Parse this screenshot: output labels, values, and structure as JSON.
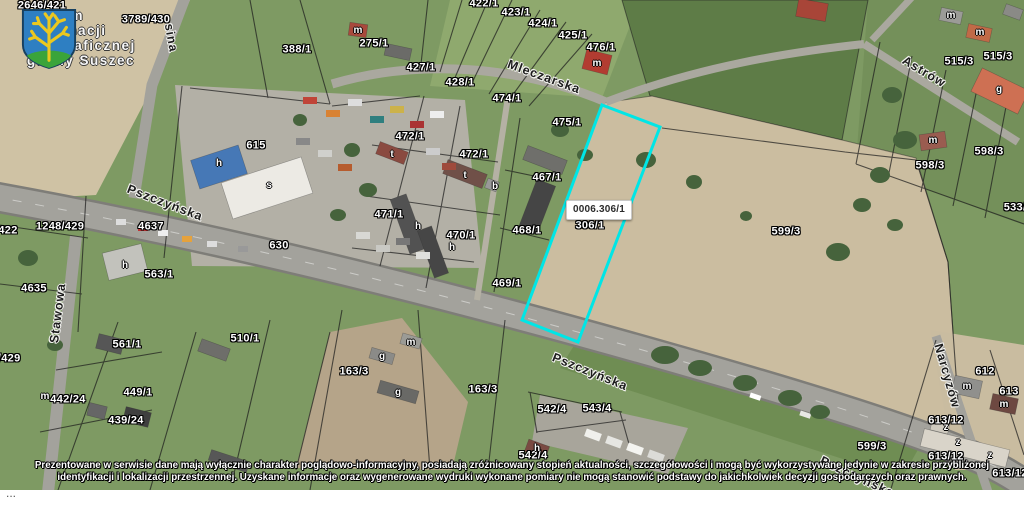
{
  "logo": {
    "lines": [
      "System",
      "Informacji",
      "Geograficznej",
      "gminy Suszec"
    ],
    "shield_colors": {
      "field": "#2e7fc2",
      "tree": "#ecc81f",
      "mound": "#3aa43a"
    }
  },
  "highlight": {
    "label": "0006.306/1",
    "points": "602,105 660,127 578,342 522,320",
    "color": "#00e6e6"
  },
  "map": {
    "parcels": [
      {
        "t": "2646/421",
        "x": 42,
        "y": 6
      },
      {
        "t": "3789/430",
        "x": 146,
        "y": 20
      },
      {
        "t": "388/1",
        "x": 297,
        "y": 50
      },
      {
        "t": "275/1",
        "x": 374,
        "y": 44
      },
      {
        "t": "427/1",
        "x": 421,
        "y": 68
      },
      {
        "t": "428/1",
        "x": 460,
        "y": 83
      },
      {
        "t": "422/1",
        "x": 484,
        "y": 4
      },
      {
        "t": "423/1",
        "x": 516,
        "y": 13
      },
      {
        "t": "424/1",
        "x": 543,
        "y": 24
      },
      {
        "t": "425/1",
        "x": 573,
        "y": 36
      },
      {
        "t": "476/1",
        "x": 601,
        "y": 48
      },
      {
        "t": "474/1",
        "x": 507,
        "y": 99
      },
      {
        "t": "475/1",
        "x": 567,
        "y": 123
      },
      {
        "t": "472/1",
        "x": 410,
        "y": 137
      },
      {
        "t": "472/1",
        "x": 474,
        "y": 155
      },
      {
        "t": "467/1",
        "x": 547,
        "y": 178
      },
      {
        "t": "471/1",
        "x": 389,
        "y": 215
      },
      {
        "t": "468/1",
        "x": 527,
        "y": 231
      },
      {
        "t": "470/1",
        "x": 461,
        "y": 236
      },
      {
        "t": "469/1",
        "x": 507,
        "y": 284
      },
      {
        "t": "615",
        "x": 256,
        "y": 146
      },
      {
        "t": "630",
        "x": 279,
        "y": 246
      },
      {
        "t": "306/1",
        "x": 590,
        "y": 226
      },
      {
        "t": "599/3",
        "x": 786,
        "y": 232
      },
      {
        "t": "598/3",
        "x": 930,
        "y": 166
      },
      {
        "t": "598/3",
        "x": 989,
        "y": 152
      },
      {
        "t": "515/3",
        "x": 959,
        "y": 62
      },
      {
        "t": "515/3",
        "x": 998,
        "y": 57
      },
      {
        "t": "533/",
        "x": 1015,
        "y": 208
      },
      {
        "t": "510/1",
        "x": 245,
        "y": 339
      },
      {
        "t": "163/3",
        "x": 354,
        "y": 372
      },
      {
        "t": "163/3",
        "x": 483,
        "y": 390
      },
      {
        "t": "542/4",
        "x": 552,
        "y": 410
      },
      {
        "t": "543/4",
        "x": 597,
        "y": 409
      },
      {
        "t": "542/4",
        "x": 533,
        "y": 456
      },
      {
        "t": "561/1",
        "x": 127,
        "y": 345
      },
      {
        "t": "563/1",
        "x": 159,
        "y": 275
      },
      {
        "t": "4637",
        "x": 151,
        "y": 227
      },
      {
        "t": "1248/429",
        "x": 60,
        "y": 227
      },
      {
        "t": "422",
        "x": 8,
        "y": 231
      },
      {
        "t": "4635",
        "x": 34,
        "y": 289
      },
      {
        "t": "9/429",
        "x": 6,
        "y": 359
      },
      {
        "t": "449/1",
        "x": 138,
        "y": 393
      },
      {
        "t": "442/24",
        "x": 68,
        "y": 400
      },
      {
        "t": "439/24",
        "x": 126,
        "y": 421
      },
      {
        "t": "612",
        "x": 985,
        "y": 372
      },
      {
        "t": "613",
        "x": 1009,
        "y": 392
      },
      {
        "t": "613/12",
        "x": 946,
        "y": 421
      },
      {
        "t": "613/12",
        "x": 946,
        "y": 457
      },
      {
        "t": "613/12",
        "x": 1010,
        "y": 474
      },
      {
        "t": "599/3",
        "x": 872,
        "y": 447
      }
    ],
    "building_labels": [
      {
        "t": "h",
        "x": 219,
        "y": 164
      },
      {
        "t": "s",
        "x": 269,
        "y": 186
      },
      {
        "t": "t",
        "x": 392,
        "y": 155
      },
      {
        "t": "t",
        "x": 465,
        "y": 176
      },
      {
        "t": "b",
        "x": 495,
        "y": 187
      },
      {
        "t": "h",
        "x": 418,
        "y": 227
      },
      {
        "t": "h",
        "x": 452,
        "y": 248
      },
      {
        "t": "h",
        "x": 125,
        "y": 266
      },
      {
        "t": "m",
        "x": 358,
        "y": 31
      },
      {
        "t": "m",
        "x": 597,
        "y": 64
      },
      {
        "t": "m",
        "x": 951,
        "y": 16
      },
      {
        "t": "m",
        "x": 980,
        "y": 33
      },
      {
        "t": "g",
        "x": 999,
        "y": 90
      },
      {
        "t": "m",
        "x": 933,
        "y": 141
      },
      {
        "t": "m",
        "x": 411,
        "y": 343
      },
      {
        "t": "g",
        "x": 382,
        "y": 357
      },
      {
        "t": "g",
        "x": 398,
        "y": 393
      },
      {
        "t": "m",
        "x": 967,
        "y": 387
      },
      {
        "t": "m",
        "x": 1004,
        "y": 405
      },
      {
        "t": "m",
        "x": 45,
        "y": 397
      },
      {
        "t": "h",
        "x": 537,
        "y": 449
      },
      {
        "t": "z",
        "x": 946,
        "y": 428
      },
      {
        "t": "z",
        "x": 958,
        "y": 443
      },
      {
        "t": "z",
        "x": 990,
        "y": 456
      }
    ],
    "streets": [
      {
        "t": "Pszczyńska",
        "x": 165,
        "y": 203,
        "a": 21
      },
      {
        "t": "Pszczyńska",
        "x": 590,
        "y": 372,
        "a": 22
      },
      {
        "t": "Pszczyńska",
        "x": 857,
        "y": 477,
        "a": 25
      },
      {
        "t": "Mleczarska",
        "x": 544,
        "y": 77,
        "a": 20
      },
      {
        "t": "Astrów",
        "x": 924,
        "y": 72,
        "a": 31
      },
      {
        "t": "Stawowa",
        "x": 58,
        "y": 313,
        "a": -83
      },
      {
        "t": "Narcyzów",
        "x": 947,
        "y": 376,
        "a": 74
      },
      {
        "t": "sina",
        "x": 171,
        "y": 38,
        "a": 80
      }
    ]
  },
  "disclaimer": {
    "line1": "Prezentowane w serwisie dane mają wyłącznie charakter poglądowo-informacyjny, posiadają zróżnicowany stopień aktualności, szczegółowości i mogą być wykorzystywane jedynie w zakresie przybliżonej",
    "line2": "identyfikacji i lokalizacji przestrzennej. Uzyskane informacje oraz wygenerowane wydruki wykonane pomiary nie mogą stanowić podstawy do jakichkolwiek decyzji gospodarczych oraz prawnych."
  },
  "footer": {
    "more": "..."
  }
}
